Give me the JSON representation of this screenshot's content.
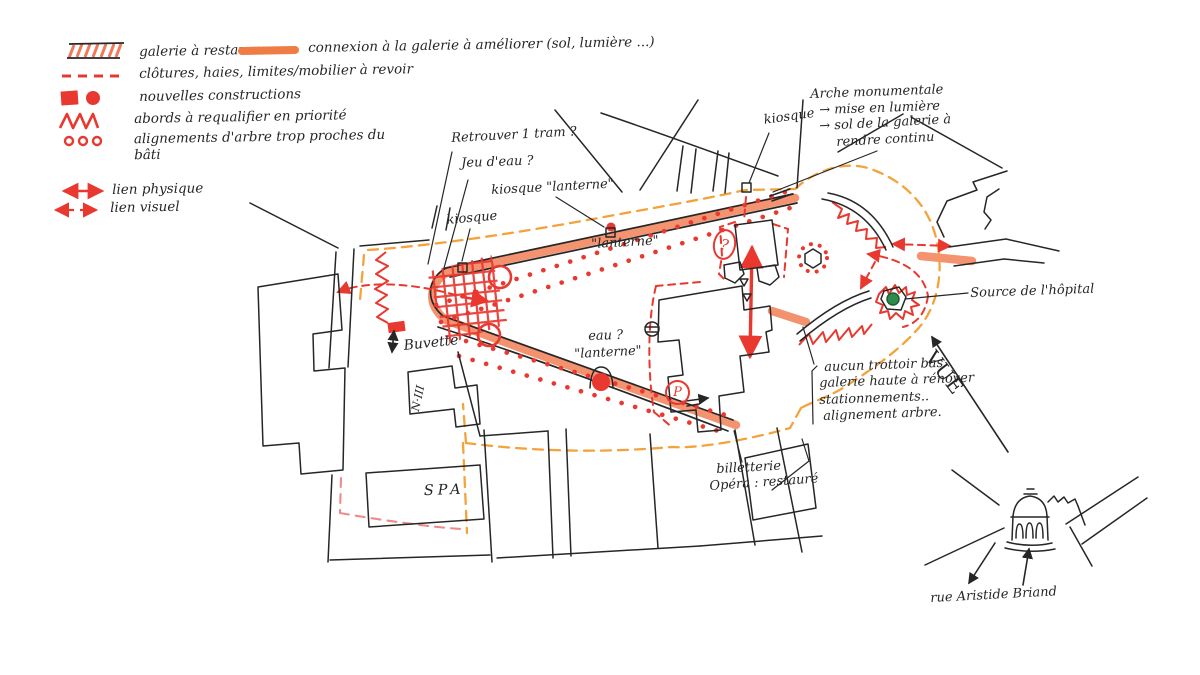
{
  "colors": {
    "ink": "#262626",
    "red": "#e8382f",
    "salmon_band": "#f2845c",
    "connexion_swatch": "#ef7b45",
    "orange_dashed": "#f3a33b",
    "pink_dashed": "#ef8a8a",
    "source_green": "#2e8b4f"
  },
  "legend": {
    "items": [
      {
        "id": "galerie",
        "swatch": "hatched-band",
        "label": "galerie à restaurer"
      },
      {
        "id": "connexion",
        "swatch": "orange-band",
        "label": "connexion à la galerie à améliorer (sol, lumière ...)"
      },
      {
        "id": "clotures",
        "swatch": "red-dashed",
        "label": "clôtures, haies, limites/mobilier à revoir"
      },
      {
        "id": "constructions",
        "swatch": "red-square-dot",
        "label": "nouvelles constructions"
      },
      {
        "id": "abords",
        "swatch": "red-zigzag",
        "label": "abords à requalifier en priorité"
      },
      {
        "id": "alignements",
        "swatch": "red-dots",
        "label": "alignements d'arbre trop proches du bâti"
      },
      {
        "id": "lien-physique",
        "swatch": "solid-double-arrow",
        "label": "lien physique"
      },
      {
        "id": "lien-visuel",
        "swatch": "dashed-double-arrow",
        "label": "lien visuel"
      }
    ]
  },
  "map": {
    "labels": {
      "retrouver": "Retrouver 1 tram ?",
      "jeu_eau": "Jeu d'eau ?",
      "kiosque_lanterne": "kiosque \"lanterne\"",
      "kiosque_left": "kiosque",
      "kiosque_top": "kiosque",
      "lanterne_top": "\"lanterne\"",
      "eau": "eau ?",
      "lanterne_bas": "\"lanterne\"",
      "buvette": "Buvette",
      "spa": "SPA",
      "batiment_n3": "N·III",
      "source": "Source de l'hôpital",
      "vue": "VUE",
      "billetterie": "billetterie",
      "opera": "Opéra : restauré",
      "rue": "rue Aristide Briand",
      "parking_badge": "P",
      "question_badge": "?"
    },
    "arche_note": {
      "title": "Arche monumentale",
      "lines": [
        "→ mise en lumière",
        "→ sol de la galerie à",
        "rendre continu"
      ]
    },
    "trottoir_note": {
      "lines": [
        "aucun trottoir bas",
        "galerie haute à rénover",
        "stationnements..",
        "alignement arbre."
      ]
    }
  }
}
